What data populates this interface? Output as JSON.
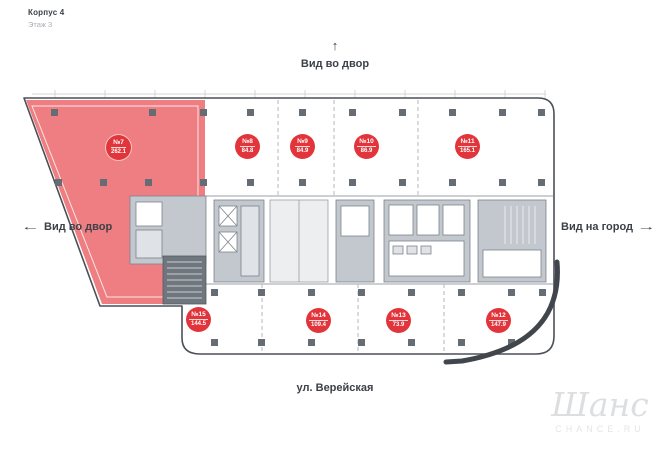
{
  "header": {
    "building": "Корпус 4",
    "floor": "Этаж 3"
  },
  "directions": {
    "top": {
      "label": "Вид во двор",
      "arrow": "↑"
    },
    "left": {
      "label": "Вид во двор",
      "arrow": "←"
    },
    "right": {
      "label": "Вид на город",
      "arrow": "→"
    }
  },
  "street": {
    "label": "ул. Верейская"
  },
  "watermark": {
    "logo": "Шанс",
    "caption": "CHANCE.RU"
  },
  "colors": {
    "highlighted_unit_fill": "#ee7e82",
    "badge_red": "#e1353b",
    "outline_gray": "#4b5056",
    "core_gray": "#c3c8ce",
    "dark_core_gray": "#6f767e"
  },
  "units": [
    {
      "number": "№7",
      "area": "262.1",
      "highlighted": true
    },
    {
      "number": "№8",
      "area": "84.8",
      "highlighted": false
    },
    {
      "number": "№9",
      "area": "84.9",
      "highlighted": false
    },
    {
      "number": "№10",
      "area": "86.9",
      "highlighted": false
    },
    {
      "number": "№11",
      "area": "165.1",
      "highlighted": false
    },
    {
      "number": "№15",
      "area": "144.5",
      "highlighted": false
    },
    {
      "number": "№14",
      "area": "109.4",
      "highlighted": false
    },
    {
      "number": "№13",
      "area": "73.9",
      "highlighted": false
    },
    {
      "number": "№12",
      "area": "147.9",
      "highlighted": false
    }
  ]
}
